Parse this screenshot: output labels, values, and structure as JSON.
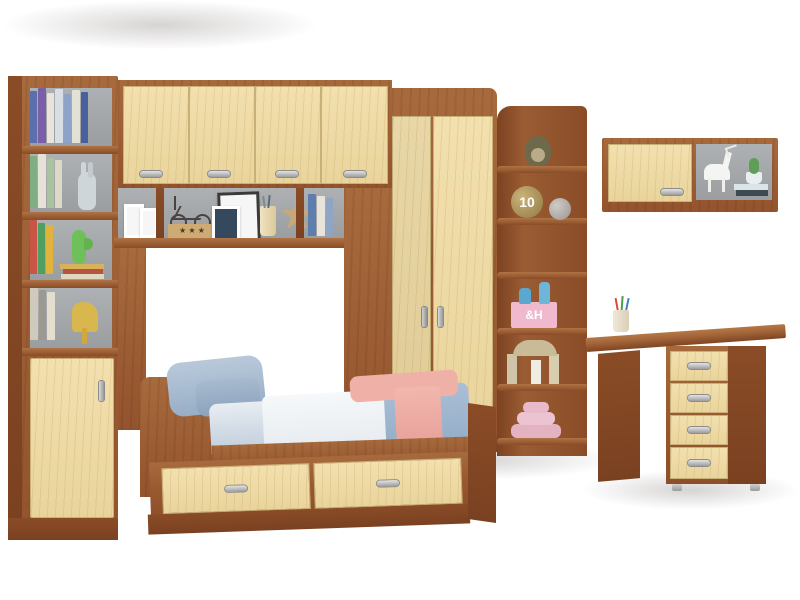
{
  "scene": {
    "description": "Product photo of a kids bedroom furniture set in walnut and maple: tall bookcase, overhead bridge cabinets, single bed with drawers, corner wardrobe, corner display shelf, wall cabinet and writing desk",
    "background": "#ffffff"
  },
  "palette": {
    "walnut": "#9a5c33",
    "walnut_light": "#a76a3d",
    "walnut_dark": "#7a4121",
    "maple": "#eed9a4",
    "handle_silver": "#c7c7c7",
    "back_panel_gray": "#a3a7ab",
    "bedding_blue": "#aabfd6",
    "bedding_white": "#f3f5f7",
    "blanket_pink": "#efb0a7",
    "floor": "#fbfbfb"
  },
  "decor": {
    "ball_number": "10",
    "box_monogram": "&H",
    "star_plaque": "★ ★ ★"
  }
}
